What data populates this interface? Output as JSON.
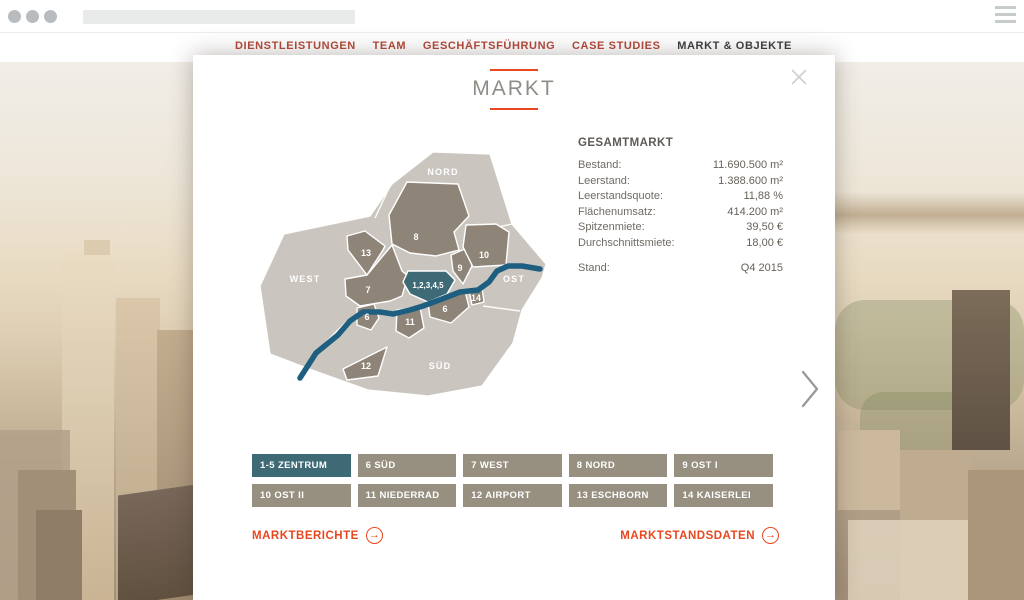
{
  "browser": {
    "address_bar_value": ""
  },
  "nav": {
    "items": [
      {
        "label": "DIENSTLEISTUNGEN",
        "active": false
      },
      {
        "label": "TEAM",
        "active": false
      },
      {
        "label": "GESCHÄFTSFÜHRUNG",
        "active": false
      },
      {
        "label": "CASE STUDIES",
        "active": false
      },
      {
        "label": "MARKT & OBJEKTE",
        "active": true
      }
    ]
  },
  "modal": {
    "title": "MARKT",
    "map": {
      "regions": {
        "nord": "NORD",
        "west": "WEST",
        "ost": "OST",
        "sued": "SÜD"
      },
      "district_labels": {
        "zentrum": "1,2,3,4,5",
        "d6_sued": "6",
        "d6_west": "6",
        "d7": "7",
        "d8": "8",
        "d9": "9",
        "d10": "10",
        "d11": "11",
        "d12": "12",
        "d13": "13",
        "d14": "14"
      },
      "selected_district": "1,2,3,4,5",
      "colors": {
        "outer_region": "#cac5bf",
        "district": "#8e8578",
        "selected": "#3e6a76",
        "river": "#1d5e81"
      }
    },
    "stats": {
      "heading": "GESAMTMARKT",
      "rows": [
        {
          "label": "Bestand:",
          "value": "11.690.500 m²"
        },
        {
          "label": "Leerstand:",
          "value": "1.388.600 m²"
        },
        {
          "label": "Leerstandsquote:",
          "value": "11,88 %"
        },
        {
          "label": "Flächenumsatz:",
          "value": "414.200 m²"
        },
        {
          "label": "Spitzenmiete:",
          "value": "39,50 €"
        },
        {
          "label": "Durchschnittsmiete:",
          "value": "18,00 €"
        }
      ],
      "stand": {
        "label": "Stand:",
        "value": "Q4 2015"
      }
    },
    "district_buttons": [
      {
        "label": "1-5 ZENTRUM",
        "selected": true
      },
      {
        "label": "6 SÜD",
        "selected": false
      },
      {
        "label": "7 WEST",
        "selected": false
      },
      {
        "label": "8 NORD",
        "selected": false
      },
      {
        "label": "9 OST I",
        "selected": false
      },
      {
        "label": "10 OST II",
        "selected": false
      },
      {
        "label": "11 NIEDERRAD",
        "selected": false
      },
      {
        "label": "12 AIRPORT",
        "selected": false
      },
      {
        "label": "13 ESCHBORN",
        "selected": false
      },
      {
        "label": "14 KAISERLEI",
        "selected": false
      }
    ],
    "links": {
      "left": {
        "label": "MARKTBERICHTE",
        "icon": "→"
      },
      "right": {
        "label": "MARKTSTANDSDATEN",
        "icon": "→"
      }
    }
  },
  "colors": {
    "accent_red": "#e8471f",
    "nav_red": "#b5493b",
    "nav_active": "#3e3f41",
    "title_gray": "#8e8d88"
  }
}
